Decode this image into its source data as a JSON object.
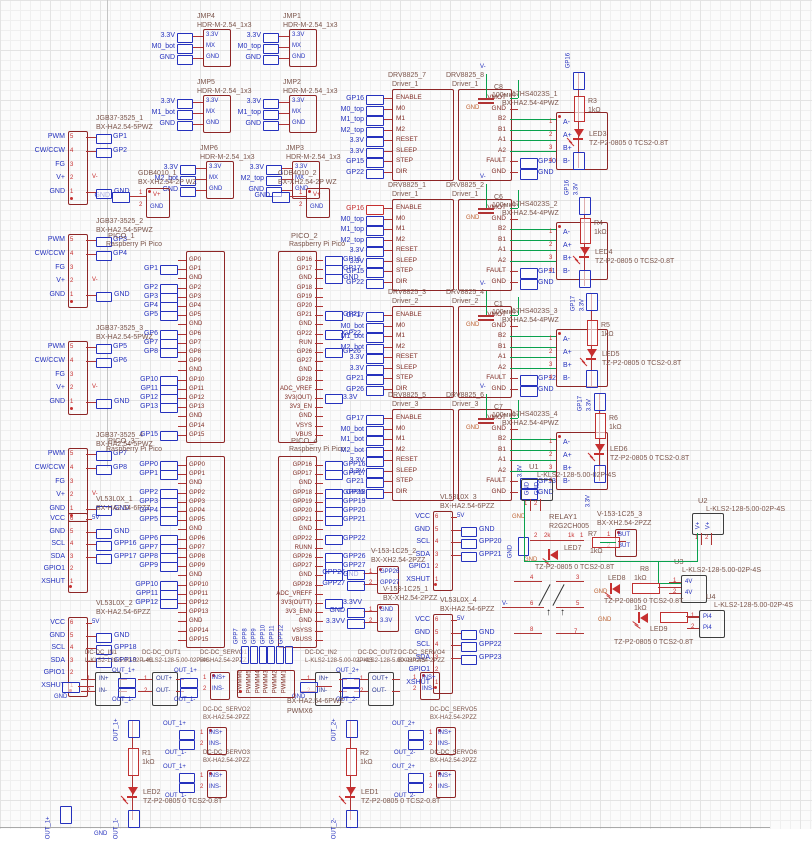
{
  "canvas": {
    "width": 812,
    "height": 842
  },
  "colors": {
    "box_stroke": "#8e2626",
    "net_blue": "#2531bd",
    "wire_red": "#b03434",
    "power_green": "#0aa14e",
    "accent_red": "#c62f2f",
    "gnd_orange": "#bc6030",
    "label_brown": "#7b554b",
    "dark_stroke": "#3d3d3d"
  },
  "headers": {
    "package": "HDR-M-2.54_1x3",
    "pins": [
      "3.3V",
      "MX",
      "GND"
    ],
    "items": [
      {
        "n": "JMP4",
        "lx": 197,
        "ly": 13,
        "x": 203,
        "y": 29,
        "nets": [
          "3.3V",
          "M0_bot",
          "GND"
        ]
      },
      {
        "n": "JMP1",
        "lx": 283,
        "ly": 13,
        "x": 289,
        "y": 29,
        "nets": [
          "3.3V",
          "M0_top",
          "GND"
        ]
      },
      {
        "n": "JMP5",
        "lx": 197,
        "ly": 79,
        "x": 203,
        "y": 95,
        "nets": [
          "3.3V",
          "M1_bot",
          "GND"
        ]
      },
      {
        "n": "JMP2",
        "lx": 283,
        "ly": 79,
        "x": 289,
        "y": 95,
        "nets": [
          "3.3V",
          "M1_top",
          "GND"
        ]
      },
      {
        "n": "JMP6",
        "lx": 200,
        "ly": 145,
        "x": 206,
        "y": 161,
        "nets": [
          "3.3V",
          "M2_bot",
          "GND"
        ]
      },
      {
        "n": "JMP3",
        "lx": 286,
        "ly": 145,
        "x": 292,
        "y": 161,
        "nets": [
          "3.3V",
          "M2_top",
          "GND"
        ]
      }
    ]
  },
  "power_connectors": {
    "package": "BX-XH2.54-2P WZ",
    "pins": [
      "V+",
      "GND"
    ],
    "gnd_net": "GND",
    "items": [
      {
        "n": "GDB4010_1",
        "x": 146,
        "y": 188,
        "lx": 138,
        "ly": 170
      },
      {
        "n": "GDB4010_2",
        "x": 306,
        "y": 188,
        "lx": 278,
        "ly": 170
      }
    ]
  },
  "motor_connectors": {
    "package": "BX-HA2.54-5PWZ",
    "pins": [
      "PWM",
      "CW/CCW",
      "FG",
      "V+",
      "GND"
    ],
    "vminus": "V-",
    "gnd_net": "GND",
    "items": [
      {
        "n": "JGB37-3525_1",
        "x": 68,
        "y": 131,
        "ly": 115,
        "nets": [
          "GP1",
          "GP2"
        ]
      },
      {
        "n": "JGB37-3525_2",
        "x": 68,
        "y": 234,
        "ly": 218,
        "nets": [
          "GP3",
          "GP4"
        ]
      },
      {
        "n": "JGB37-3525_3",
        "x": 68,
        "y": 341,
        "ly": 325,
        "nets": [
          "GP5",
          "GP6"
        ]
      },
      {
        "n": "JGB37-3525_4",
        "x": 68,
        "y": 448,
        "ly": 432,
        "nets": [
          "GP7",
          "GP8"
        ]
      }
    ]
  },
  "tof_sensors": {
    "package": "BX-HA2.54-6PZZ",
    "pins": [
      "VCC",
      "GND",
      "SCL",
      "SDA",
      "GPIO1",
      "XSHUT"
    ],
    "vcc_net": "5V",
    "items": [
      {
        "n": "VL53L0X_1",
        "x": 68,
        "y": 513,
        "lx": 96,
        "ly": 496,
        "nets": [
          "GND",
          "GPP16",
          "GPP17"
        ]
      },
      {
        "n": "VL53L0X_2",
        "x": 68,
        "y": 617,
        "lx": 96,
        "ly": 600,
        "nets": [
          "GND",
          "GPP18",
          "GPP19"
        ]
      },
      {
        "n": "VL53L0X_3",
        "x": 433,
        "y": 511,
        "lx": 440,
        "ly": 494,
        "nets": [
          "GND",
          "GPP20",
          "GPP21"
        ]
      },
      {
        "n": "VL53L0X_4",
        "x": 433,
        "y": 614,
        "lx": 440,
        "ly": 597,
        "nets": [
          "GND",
          "GPP22",
          "GPP23"
        ]
      }
    ]
  },
  "picos": {
    "subtitle": "Raspberry Pi Pico",
    "items": [
      {
        "n": "PICO_1",
        "x": 186,
        "y": 251,
        "lx": 108,
        "ly": 232,
        "side": "left",
        "pins": [
          "GP0",
          "GP1",
          "GND",
          "GP2",
          "GP3",
          "GP4",
          "GP5",
          "GND",
          "GP6",
          "GP7",
          "GP8",
          "GP9",
          "GND",
          "GP10",
          "GP11",
          "GP12",
          "GP13",
          "GND",
          "GP14",
          "GP15"
        ],
        "flags": [
          [
            1,
            "GP1"
          ],
          [
            3,
            "GP2"
          ],
          [
            4,
            "GP3"
          ],
          [
            5,
            "GP4"
          ],
          [
            6,
            "GP5"
          ],
          [
            8,
            "GP6"
          ],
          [
            9,
            "GP7"
          ],
          [
            10,
            "GP8"
          ],
          [
            13,
            "GP10"
          ],
          [
            14,
            "GP11"
          ],
          [
            15,
            "GP12"
          ],
          [
            16,
            "GP13"
          ],
          [
            19,
            "GP15"
          ]
        ]
      },
      {
        "n": "PICO_2",
        "x": 278,
        "y": 251,
        "lx": 291,
        "ly": 232,
        "side": "right",
        "pins": [
          "GP16",
          "GP17",
          "GND",
          "GP18",
          "GP19",
          "GP20",
          "GP21",
          "GND",
          "GP22",
          "RUN",
          "GP26",
          "GP27",
          "GND",
          "GP28",
          "ADC_VREF",
          "3V3(OUT)",
          "3V3_EN",
          "GND",
          "VSYS",
          "VBUS"
        ],
        "flags": [
          [
            0,
            "GP16"
          ],
          [
            1,
            "GP17"
          ],
          [
            2,
            "GND"
          ],
          [
            6,
            "GP21"
          ],
          [
            8,
            "GP22"
          ],
          [
            10,
            "GP26"
          ],
          [
            15,
            "3.3V"
          ]
        ]
      },
      {
        "n": "PICO_3",
        "x": 186,
        "y": 456,
        "lx": 108,
        "ly": 437,
        "side": "left",
        "pins": [
          "GPP0",
          "GPP1",
          "GND",
          "GPP2",
          "GPP3",
          "GPP4",
          "GPP5",
          "GND",
          "GPP6",
          "GPP7",
          "GPP8",
          "GPP9",
          "GND",
          "GPP10",
          "GPP11",
          "GPP12",
          "GPP13",
          "GND",
          "GPP14",
          "GPP15"
        ],
        "flags": [
          [
            0,
            "GPP0"
          ],
          [
            1,
            "GPP1"
          ],
          [
            3,
            "GPP2"
          ],
          [
            4,
            "GPP3"
          ],
          [
            5,
            "GPP4"
          ],
          [
            6,
            "GPP5"
          ],
          [
            8,
            "GPP6"
          ],
          [
            9,
            "GPP7"
          ],
          [
            10,
            "GPP8"
          ],
          [
            11,
            "GPP9"
          ],
          [
            13,
            "GPP10"
          ],
          [
            14,
            "GPP11"
          ],
          [
            15,
            "GPP12"
          ]
        ]
      },
      {
        "n": "PICO_4",
        "x": 278,
        "y": 456,
        "lx": 291,
        "ly": 437,
        "side": "right",
        "pins": [
          "GPP16",
          "GPP17",
          "GND",
          "GPP18",
          "GPP19",
          "GPP20",
          "GPP21",
          "GND",
          "GPP22",
          "RUNN",
          "GPP26",
          "GPP27",
          "GND",
          "GPP28",
          "ADC_VREFF",
          "3V3(OUTT)",
          "3V3_ENN",
          "GND",
          "VSYSS",
          "VBUSS"
        ],
        "flags": [
          [
            0,
            "GPP16"
          ],
          [
            1,
            "GPP17"
          ],
          [
            3,
            "GPP18"
          ],
          [
            4,
            "GPP19"
          ],
          [
            5,
            "GPP20"
          ],
          [
            6,
            "GPP21"
          ],
          [
            8,
            "GPP22"
          ],
          [
            10,
            "GPP26"
          ],
          [
            11,
            "GPP27"
          ],
          [
            12,
            "GND"
          ],
          [
            15,
            "3.3VV"
          ]
        ]
      }
    ]
  },
  "rotlabels": {
    "x": 240,
    "y": 645,
    "step": 9,
    "items": [
      "GPP7",
      "GPP8",
      "GPP9",
      "GPP10",
      "GPP11",
      "GPP12"
    ]
  },
  "drivers": {
    "left_pins": [
      "ENABLE",
      "M0",
      "M1",
      "M2",
      "RESET",
      "SLEEP",
      "STEP",
      "DIR"
    ],
    "right_pins": [
      "VMOT",
      "GND",
      "B2",
      "B1",
      "A1",
      "A2",
      "FAULT",
      "GND"
    ],
    "stepper_package": "BX-HA2.54-4PWZ",
    "stepper_pins": [
      "A-",
      "A+",
      "B+",
      "B-"
    ],
    "cap_value": "100мкФ",
    "cap_gnd": "GND",
    "vminus": "V-",
    "driver_label": "Driver",
    "pairs": [
      {
        "ln": "DRV8825_7",
        "ls": "Driver_1",
        "rn": "DRV8825_8",
        "rs": "Driver_1",
        "y": 72,
        "red": -1,
        "nets": [
          "GP16",
          "M0_top",
          "M1_top",
          "M2_top",
          "3.3V",
          "3.3V",
          "GP15",
          "GP22"
        ],
        "cap": "C8",
        "fault": [
          "GP10",
          "GND"
        ],
        "stepper": "17HS4023S_1"
      },
      {
        "ln": "DRV8825_1",
        "ls": "Driver_1",
        "rn": "DRV8825_2",
        "rs": "Driver_1",
        "y": 182,
        "red": 0,
        "nets": [
          "GP16",
          "M0_top",
          "M1_top",
          "M2_top",
          "3.3V",
          "3.3V",
          "GP15",
          "GP22"
        ],
        "cap": "C6",
        "fault": [
          "GP11",
          "GND"
        ],
        "stepper": "17HS4023S_2"
      },
      {
        "ln": "DRV8825_3",
        "ls": "Driver_2",
        "rn": "DRV8825_4",
        "rs": "Driver_2",
        "y": 289,
        "red": -1,
        "nets": [
          "GP17",
          "M0_bot",
          "M1_bot",
          "M2_bot",
          "3.3V",
          "3.3V",
          "GP21",
          "GP26"
        ],
        "cap": "C1",
        "fault": [
          "GP12",
          "GND"
        ],
        "stepper": "17HS4023S_3"
      },
      {
        "ln": "DRV8825_5",
        "ls": "Driver_3",
        "rn": "DRV8825_6",
        "rs": "Driver_3",
        "y": 392,
        "red": -1,
        "nets": [
          "GP17",
          "M0_bot",
          "M1_bot",
          "M2_bot",
          "3.3V",
          "3.3V",
          "GP21",
          "GP26"
        ],
        "cap": "C7",
        "fault": [
          "GP13",
          "GND"
        ],
        "stepper": "17HS4023S_4"
      }
    ]
  },
  "led_chains_meta": {
    "rv": "1kΩ",
    "part": "TZ-P2-0805 0 TCS2-0.8T"
  },
  "led_chains": [
    {
      "x": 575,
      "top": "GP16",
      "fy1": 72,
      "ry": 96,
      "r": "R3",
      "ly": 128,
      "fy2": 152,
      "bot": [
        "GP16",
        "3.3V"
      ],
      "by": 196,
      "led": "LED3"
    },
    {
      "x": 581,
      "top": null,
      "fy1": 197,
      "ry": 218,
      "r": "R4",
      "ly": 246,
      "fy2": 270,
      "bot": [
        "GP17",
        "3.3V"
      ],
      "by": 312,
      "led": "LED4"
    },
    {
      "x": 588,
      "top": null,
      "fy1": 293,
      "ry": 320,
      "r": "R5",
      "ly": 348,
      "fy2": 370,
      "bot": [
        "GP17",
        "3.3V"
      ],
      "by": 412,
      "led": "LED5"
    },
    {
      "x": 596,
      "top": null,
      "fy1": 393,
      "ry": 413,
      "r": "R6",
      "ly": 443,
      "fy2": 465,
      "bot": [
        "3.3V"
      ],
      "by": 508,
      "led": "LED6"
    }
  ],
  "kls_terminals": {
    "package": "L-KLS2-128-5.00-02P-4S",
    "items": [
      {
        "n": "U1",
        "type": "v",
        "x": 521,
        "y": 479,
        "lx": 529,
        "ly": 463,
        "pins": [
          "GND",
          "GND"
        ]
      },
      {
        "n": "U2",
        "type": "v",
        "x": 692,
        "y": 513,
        "lx": 698,
        "ly": 497,
        "pins": [
          "V+",
          "V+"
        ]
      },
      {
        "n": "U3",
        "type": "h",
        "x": 681,
        "y": 575,
        "lx": 674,
        "ly": 558,
        "pins": [
          "4V",
          "4V"
        ]
      },
      {
        "n": "U4",
        "type": "h",
        "x": 699,
        "y": 610,
        "lx": 706,
        "ly": 593,
        "pins": [
          "Pi4",
          "Pi4"
        ]
      }
    ]
  },
  "xh_connectors": {
    "package": "BX-XH2.54-2PZZ",
    "items": [
      {
        "n": "V-153-1C25_2",
        "x": 377,
        "y": 566,
        "lx": 371,
        "ly": 548,
        "pins": [
          "GPP26",
          "GPP27"
        ],
        "flags": [
          "GPP26",
          "GPP27"
        ]
      },
      {
        "n": "V-153-1C25_1",
        "x": 377,
        "y": 604,
        "lx": 383,
        "ly": 586,
        "pins": [
          "GND",
          "3.3V"
        ],
        "flags": [
          "GND",
          "3.3VV"
        ]
      },
      {
        "n": "V-153-1C25_3",
        "x": 615,
        "y": 529,
        "lx": 597,
        "ly": 511,
        "pins": [
          "BUT",
          "BUT"
        ],
        "flags": null
      }
    ]
  },
  "relay_block": {
    "name": "RELAY1",
    "part": "R2G2CH005",
    "coil_pins": [
      "2",
      "1"
    ],
    "coil_values": [
      "2k",
      "1k"
    ],
    "r7": {
      "name": "R7",
      "value": "1kΩ"
    },
    "led7": {
      "name": "LED7",
      "part": "TZ-P2-0805 0 TCS2-0.8T"
    },
    "contact_pins": [
      "4",
      "3",
      "6",
      "5",
      "8",
      "7"
    ],
    "vminus": "V-",
    "gnd": "GND",
    "u3row": {
      "r": "R8",
      "rv": "1kΩ",
      "led": "LED8",
      "part": "TZ-P2-0805 0 TCS2-0.8T"
    },
    "u4row": {
      "rv": "1kΩ",
      "led": "LED9",
      "part": "TZ-P2-0805 0 TCS2-0.8T"
    }
  },
  "bottom": {
    "dc_package": "L-KLS2-128-5.00-02P-4S",
    "dc_boxes": [
      {
        "n": "DC-DC_IN1",
        "x": 95,
        "pins": [
          "IN+",
          "IN-"
        ]
      },
      {
        "n": "DC-DC_OUT1",
        "x": 152,
        "pins": [
          "OUT+",
          "OUT-"
        ]
      },
      {
        "n": "DC-DC_IN2",
        "x": 315,
        "pins": [
          "IN+",
          "IN-"
        ]
      },
      {
        "n": "DC-DC_OUT2",
        "x": 368,
        "pins": [
          "OUT+",
          "OUT-"
        ]
      }
    ],
    "ffs": [
      {
        "x": 118,
        "t": "OUT_1+",
        "b": "OUT_1-"
      },
      {
        "x": 180,
        "t": "OUT_1+",
        "b": "OUT_1-"
      },
      {
        "x": 342,
        "t": "OUT_2+",
        "b": "OUT_2-"
      }
    ],
    "servo_package": "BX-HA2.54-2PZZ",
    "servo_pins": [
      "INS+",
      "INS-"
    ],
    "servos": [
      {
        "n": "DC-DC_SERVO1",
        "x": 210,
        "y": 672,
        "lx": 200,
        "ly": 650,
        "nets": null
      },
      {
        "n": "DC-DC_SERVO4",
        "x": 420,
        "y": 672,
        "lx": 398,
        "ly": 650,
        "nets": null
      },
      {
        "n": "DC-DC_SERVO2",
        "x": 207,
        "y": 727,
        "lx": 203,
        "ly": 707,
        "nets": [
          "OUT_1+",
          "OUT_1-"
        ]
      },
      {
        "n": "DC-DC_SERVO3",
        "x": 207,
        "y": 770,
        "lx": 203,
        "ly": 750,
        "nets": [
          "OUT_1+",
          "OUT_1-"
        ]
      },
      {
        "n": "DC-DC_SERVO5",
        "x": 436,
        "y": 727,
        "lx": 430,
        "ly": 707,
        "nets": [
          "OUT_2+",
          "OUT_2-"
        ]
      },
      {
        "n": "DC-DC_SERVO6",
        "x": 436,
        "y": 770,
        "lx": 430,
        "ly": 750,
        "nets": [
          "OUT_2+",
          "OUT_2-"
        ]
      }
    ],
    "pwm_header": {
      "name": "PWMX6",
      "package": "BX-HA2.54-6PWZ",
      "x": 237,
      "y": 670,
      "lx": 287,
      "ly": 698,
      "pins": [
        "PWMM6",
        "PWMM5",
        "PWMM4",
        "PWMM3",
        "PWMM2",
        "PWMM1"
      ]
    },
    "chains": [
      {
        "x": 130,
        "top": "OUT_1+",
        "r": "R1",
        "rv": "1kΩ",
        "led": "LED2",
        "part": "TZ-P2-0805 0 TCS2-0.8T",
        "bot": "OUT_1-"
      },
      {
        "x": 348,
        "top": "OUT_2+",
        "r": "R2",
        "rv": "1kΩ",
        "led": "LED1",
        "part": "TZ-P2-0805 0 TCS2-0.8T",
        "bot": "OUT_2-"
      }
    ],
    "gflags": [
      {
        "x": 62,
        "y": 682
      },
      {
        "x": 300,
        "y": 682
      }
    ],
    "gnd_label": "GND",
    "bflag": {
      "x": 60,
      "y": 806,
      "label": "OUT_1+"
    }
  },
  "texts": [
    {
      "x": 524,
      "y": 478,
      "t": "3.3V",
      "rot": true,
      "c": "blue sm"
    },
    {
      "x": 94,
      "y": 831,
      "t": "GND",
      "c": "blue sm"
    }
  ],
  "wires": [
    {
      "x": 107,
      "y": 0,
      "w": 1,
      "h": 468,
      "c": "#c4c4c4"
    },
    {
      "x": 0,
      "y": 827,
      "w": 770,
      "h": 1,
      "c": "#a8a8a8"
    }
  ]
}
